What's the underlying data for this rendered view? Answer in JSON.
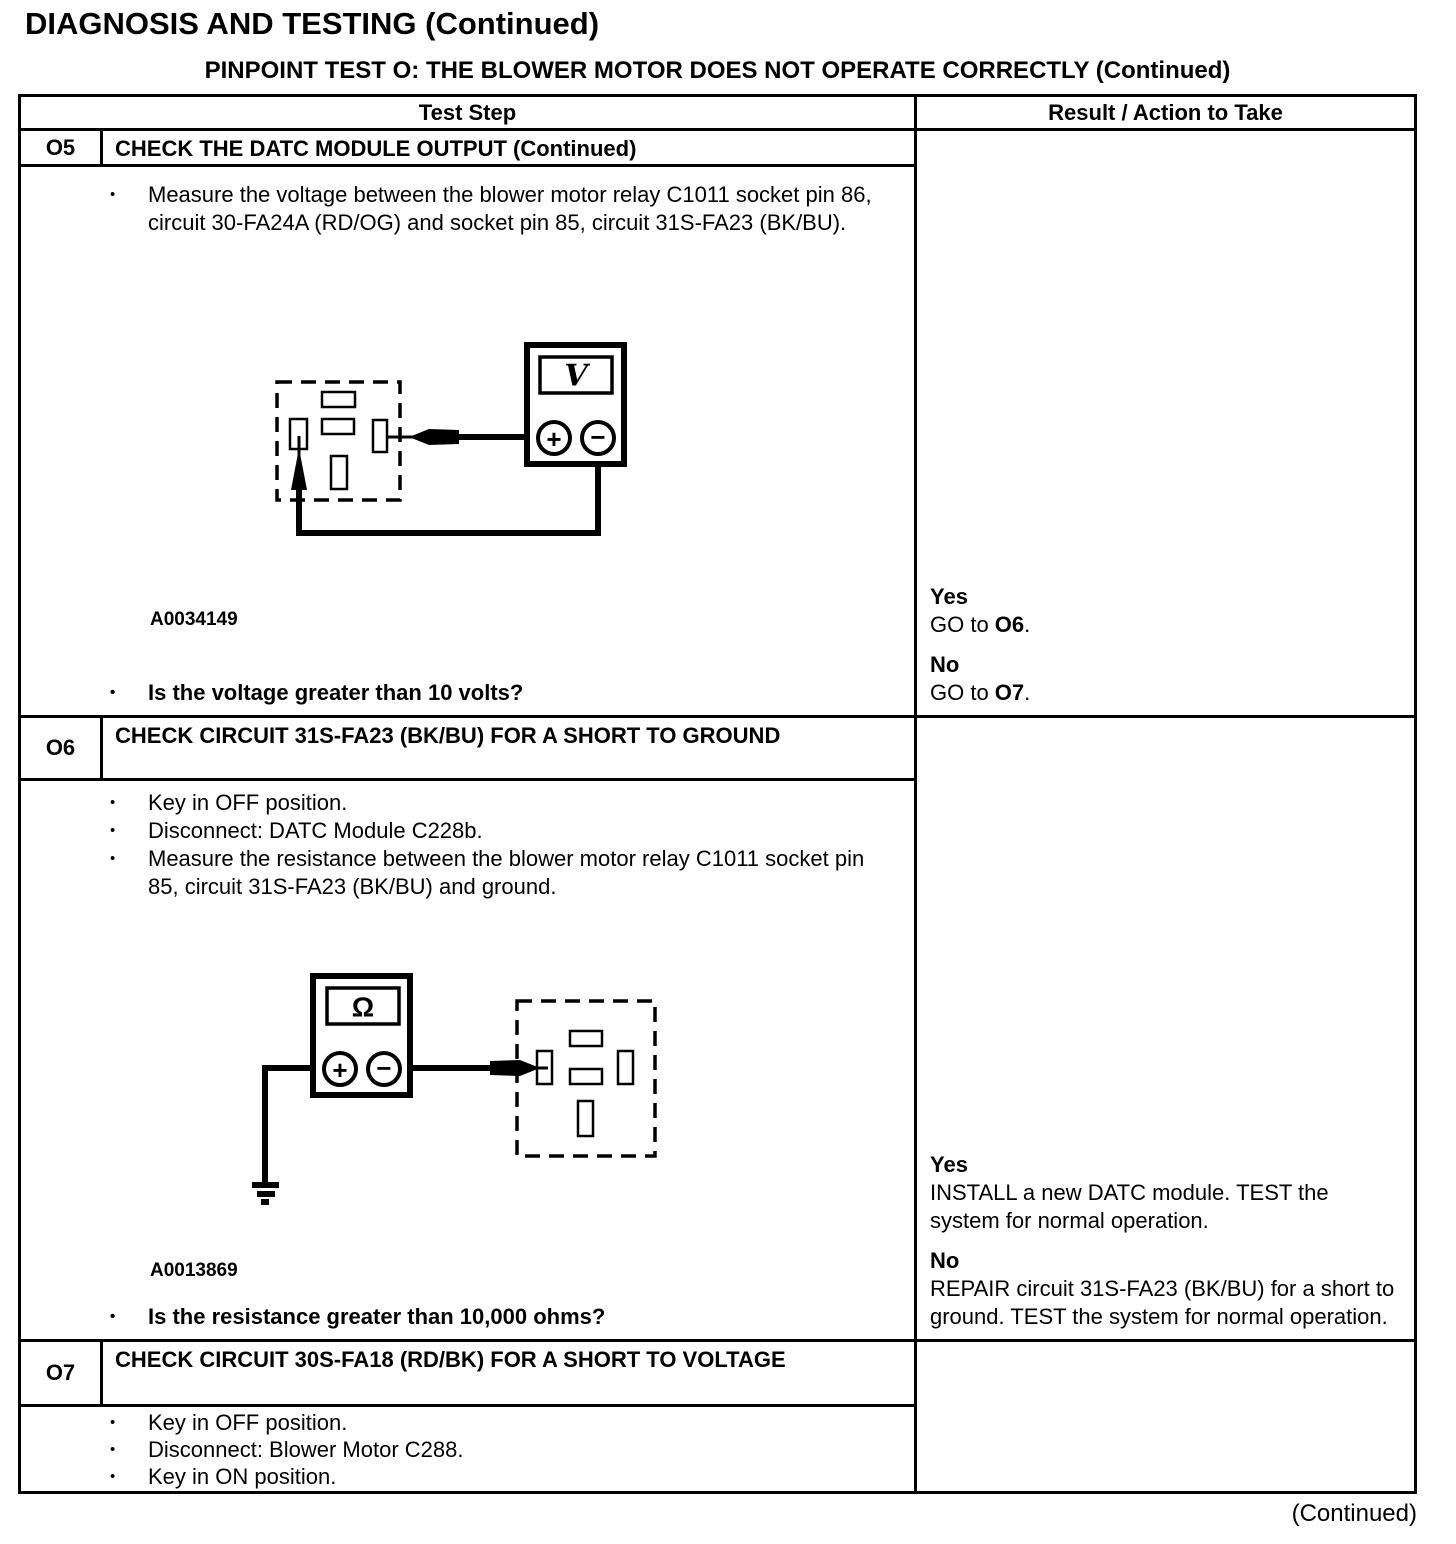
{
  "page": {
    "heading": "DIAGNOSIS AND TESTING (Continued)",
    "subheading": "PINPOINT TEST O: THE BLOWER MOTOR DOES NOT OPERATE CORRECTLY (Continued)",
    "footer_continued": "(Continued)"
  },
  "glyphs": {
    "bullet": "•",
    "plus": "+",
    "minus": "−"
  },
  "table": {
    "headers": {
      "test_step": "Test Step",
      "result": "Result / Action to Take"
    },
    "rows": [
      {
        "id": "O5",
        "title": "CHECK THE DATC MODULE OUTPUT (Continued)",
        "bullets": [
          "Measure the voltage between the blower motor relay C1011 socket pin 86, circuit 30-FA24A (RD/OG) and socket pin 85, circuit 31S-FA23 (BK/BU)."
        ],
        "figure": {
          "label": "A0034149",
          "meter_symbol": "V"
        },
        "question": "Is the voltage greater than 10 volts?",
        "result": {
          "yes": {
            "label": "Yes",
            "pre": "GO to ",
            "target": "O6",
            "post": "."
          },
          "no": {
            "label": "No",
            "pre": "GO to ",
            "target": "O7",
            "post": "."
          }
        }
      },
      {
        "id": "O6",
        "title": "CHECK CIRCUIT 31S-FA23 (BK/BU) FOR A SHORT TO GROUND",
        "bullets": [
          "Key in OFF position.",
          "Disconnect: DATC Module C228b.",
          "Measure the resistance between the blower motor relay C1011 socket pin 85, circuit 31S-FA23 (BK/BU) and ground."
        ],
        "figure": {
          "label": "A0013869",
          "meter_symbol": "Ω"
        },
        "question": "Is the resistance greater than 10,000 ohms?",
        "result": {
          "yes": {
            "label": "Yes",
            "text": "INSTALL a new DATC module. TEST the system for normal operation."
          },
          "no": {
            "label": "No",
            "text": "REPAIR circuit 31S-FA23 (BK/BU) for a short to ground. TEST the system for normal operation."
          }
        }
      },
      {
        "id": "O7",
        "title": "CHECK CIRCUIT 30S-FA18 (RD/BK) FOR A SHORT TO VOLTAGE",
        "bullets": [
          "Key in OFF position.",
          "Disconnect: Blower Motor C288.",
          "Key in ON position."
        ]
      }
    ]
  }
}
